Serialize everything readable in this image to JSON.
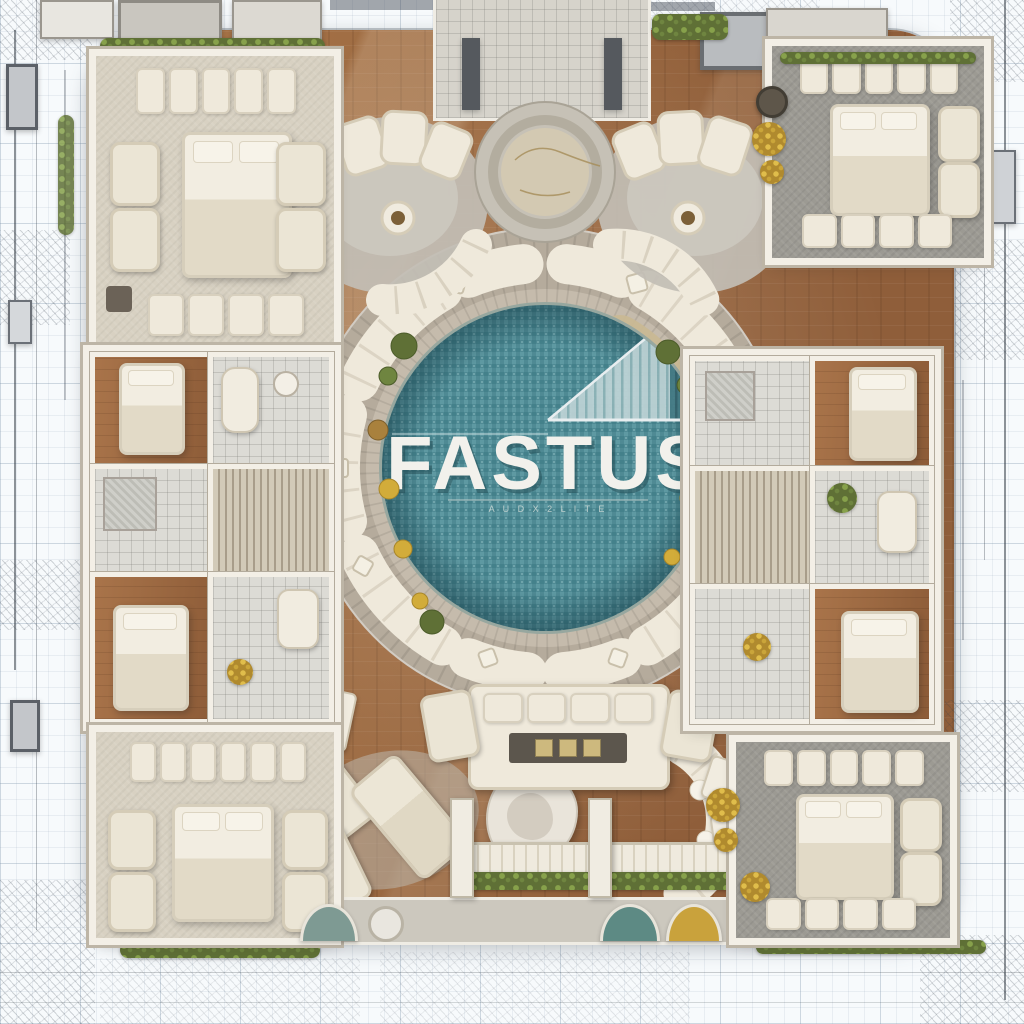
{
  "logo": {
    "title": "FASTUS",
    "tagline": "A U D X 2 L I T E"
  },
  "palette": {
    "pool_teal": "#4f8a94",
    "pool_teal_dark": "#3f727c",
    "wood_brown": "#a5714a",
    "stone_gray": "#b5ab9c",
    "wall_white": "#f3efe6",
    "sofa_cream": "#efe9db",
    "carpet_beige": "#d8d1c2",
    "carpet_gray": "#9c9a93",
    "hedge_green": "#5f7036",
    "accent_gold": "#d2ac3a",
    "blueprint_line": "#8ca0b4"
  }
}
